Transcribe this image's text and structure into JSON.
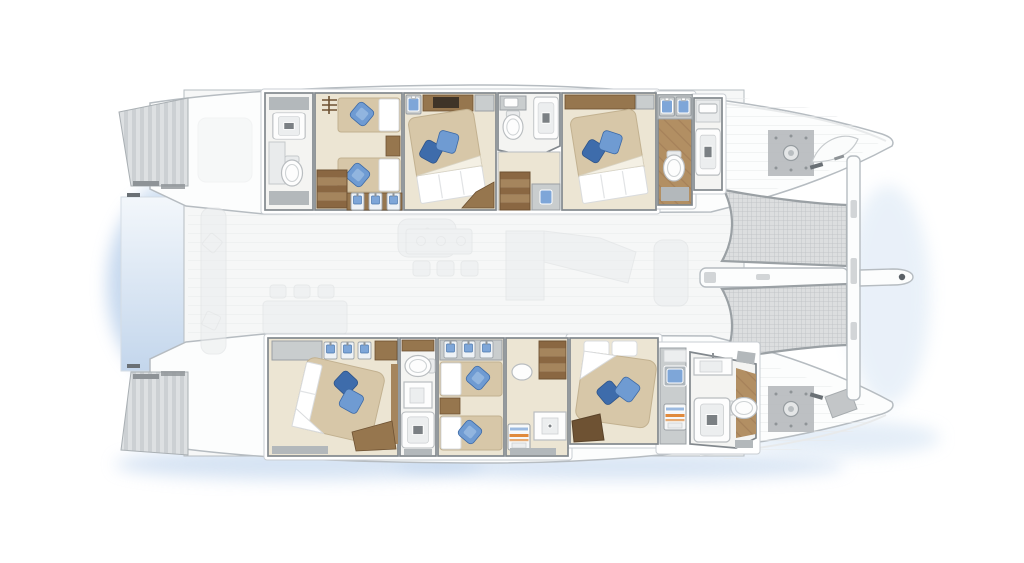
{
  "canvas": {
    "width": 1024,
    "height": 563,
    "background": "#ffffff"
  },
  "vessel": {
    "type": "catamaran-two-deck-floor-plan",
    "orientation": "bow-right",
    "counts": {
      "cabins": 6,
      "double_cabins": 4,
      "twin_cabins": 2,
      "bathrooms": 6,
      "trampoline_nets": 2,
      "winches": 2,
      "swim_step_platforms": 2
    }
  },
  "rooms": [
    {
      "id": "port-aft-bathroom",
      "type": "bathroom",
      "fixtures": [
        "shower",
        "vanity",
        "toilet",
        "mat"
      ]
    },
    {
      "id": "port-aft-twin-cabin",
      "type": "twin-cabin",
      "beds": 2,
      "pillow_color": "blue",
      "features": [
        "stairs",
        "wardrobe-lockers",
        "nightstand"
      ]
    },
    {
      "id": "port-mid-double-cabin",
      "type": "double-cabin",
      "beds": 1,
      "pillow_color": "blue",
      "features": [
        "desk-tv",
        "vanity",
        "cabinet"
      ]
    },
    {
      "id": "port-mid-bathroom",
      "type": "bathroom",
      "fixtures": [
        "sink",
        "toilet",
        "shower"
      ],
      "features": [
        "companionway-stairs",
        "blue-sink-counter"
      ]
    },
    {
      "id": "port-fwd-double-cabin",
      "type": "double-cabin",
      "beds": 1,
      "pillow_color": "blue",
      "features": [
        "wood-shelf",
        "cabinet"
      ]
    },
    {
      "id": "port-fwd-bathroom",
      "type": "bathroom",
      "fixtures": [
        "double-blue-sink",
        "toilet",
        "mat"
      ],
      "floor": "wood"
    },
    {
      "id": "port-fwd-shower",
      "type": "shower-room",
      "fixtures": [
        "cabinet-sink",
        "shower"
      ]
    },
    {
      "id": "stbd-aft-double-cabin",
      "type": "double-cabin",
      "beds": 1,
      "pillow_color": "blue",
      "features": [
        "cabinet",
        "wardrobe-lockers",
        "bench"
      ]
    },
    {
      "id": "stbd-aft-bathroom",
      "type": "bathroom",
      "fixtures": [
        "toilet",
        "sink",
        "shower",
        "mat"
      ]
    },
    {
      "id": "stbd-mid-twin-cabin",
      "type": "twin-cabin",
      "beds": 2,
      "pillow_color": "blue",
      "features": [
        "wardrobe-lockers",
        "nightstand"
      ]
    },
    {
      "id": "stbd-companionway",
      "type": "landing",
      "features": [
        "stairs",
        "side-table",
        "washer",
        "sink-counter",
        "mat"
      ]
    },
    {
      "id": "stbd-fwd-double-cabin",
      "type": "double-cabin",
      "beds": 1,
      "pillow_color": "blue",
      "features": [
        "head-pillows",
        "bench"
      ]
    },
    {
      "id": "stbd-fwd-bathroom",
      "type": "bathroom",
      "fixtures": [
        "blue-sink",
        "washer",
        "sink",
        "shower",
        "toilet",
        "mat"
      ],
      "floor": "partial-wood"
    }
  ],
  "main_deck_ghost": [
    "aft-cockpit-sofa",
    "cockpit-pillows",
    "dining-table-with-chairs",
    "armchair",
    "galley-island-with-stools",
    "salon-l-sofa",
    "helm-seat"
  ],
  "exterior": [
    "stern-swim-steps-port",
    "stern-swim-steps-starboard",
    "aft-hydraulic-platform",
    "foredeck-port-winch",
    "foredeck-starboard-winch",
    "trampoline-net-port",
    "trampoline-net-starboard",
    "forward-crossbeam",
    "center-spine",
    "bowsprit",
    "bow-locker",
    "deck-hatch"
  ],
  "colors": {
    "hull": "#fcfdfd",
    "hullEdge": "#b6bcc1",
    "deck": "#f6f7f7",
    "deckLine": "#e8eaeb",
    "casing": "#ffffff",
    "wall": "#82888d",
    "floor": "#ece5d3",
    "floorBath": "#f4f4f2",
    "bedTan": "#d7c7a8",
    "bedEdge": "#c2b190",
    "pDark": "#3e6cab",
    "pMid": "#6f9bd2",
    "pHi": "#a9c6e8",
    "lockerBlue": "#7ea6d8",
    "wood": "#96764e",
    "woodMid": "#a5855d",
    "woodDark": "#6e5233",
    "woodFloor": "#b28f63",
    "mat": "#b3b8bb",
    "fixGray": "#c9cdce",
    "drain": "#7b8084",
    "mesh": "#dcdedf",
    "meshLine": "#bcc0c3",
    "meshEdge": "#9aa0a4",
    "stripeA": "#ccd0d3",
    "stripeB": "#dde0e2",
    "platTop": "#f3f7fb",
    "platBot": "#c3d6ec",
    "water": "#b5cdea",
    "water2": "#cfe0f2",
    "ghost": "#ebedee",
    "ghostEdge": "#dcdfe1",
    "orange": "#e08a3c",
    "tv": "#3f3428",
    "winchPlate": "#b7bbbe"
  }
}
